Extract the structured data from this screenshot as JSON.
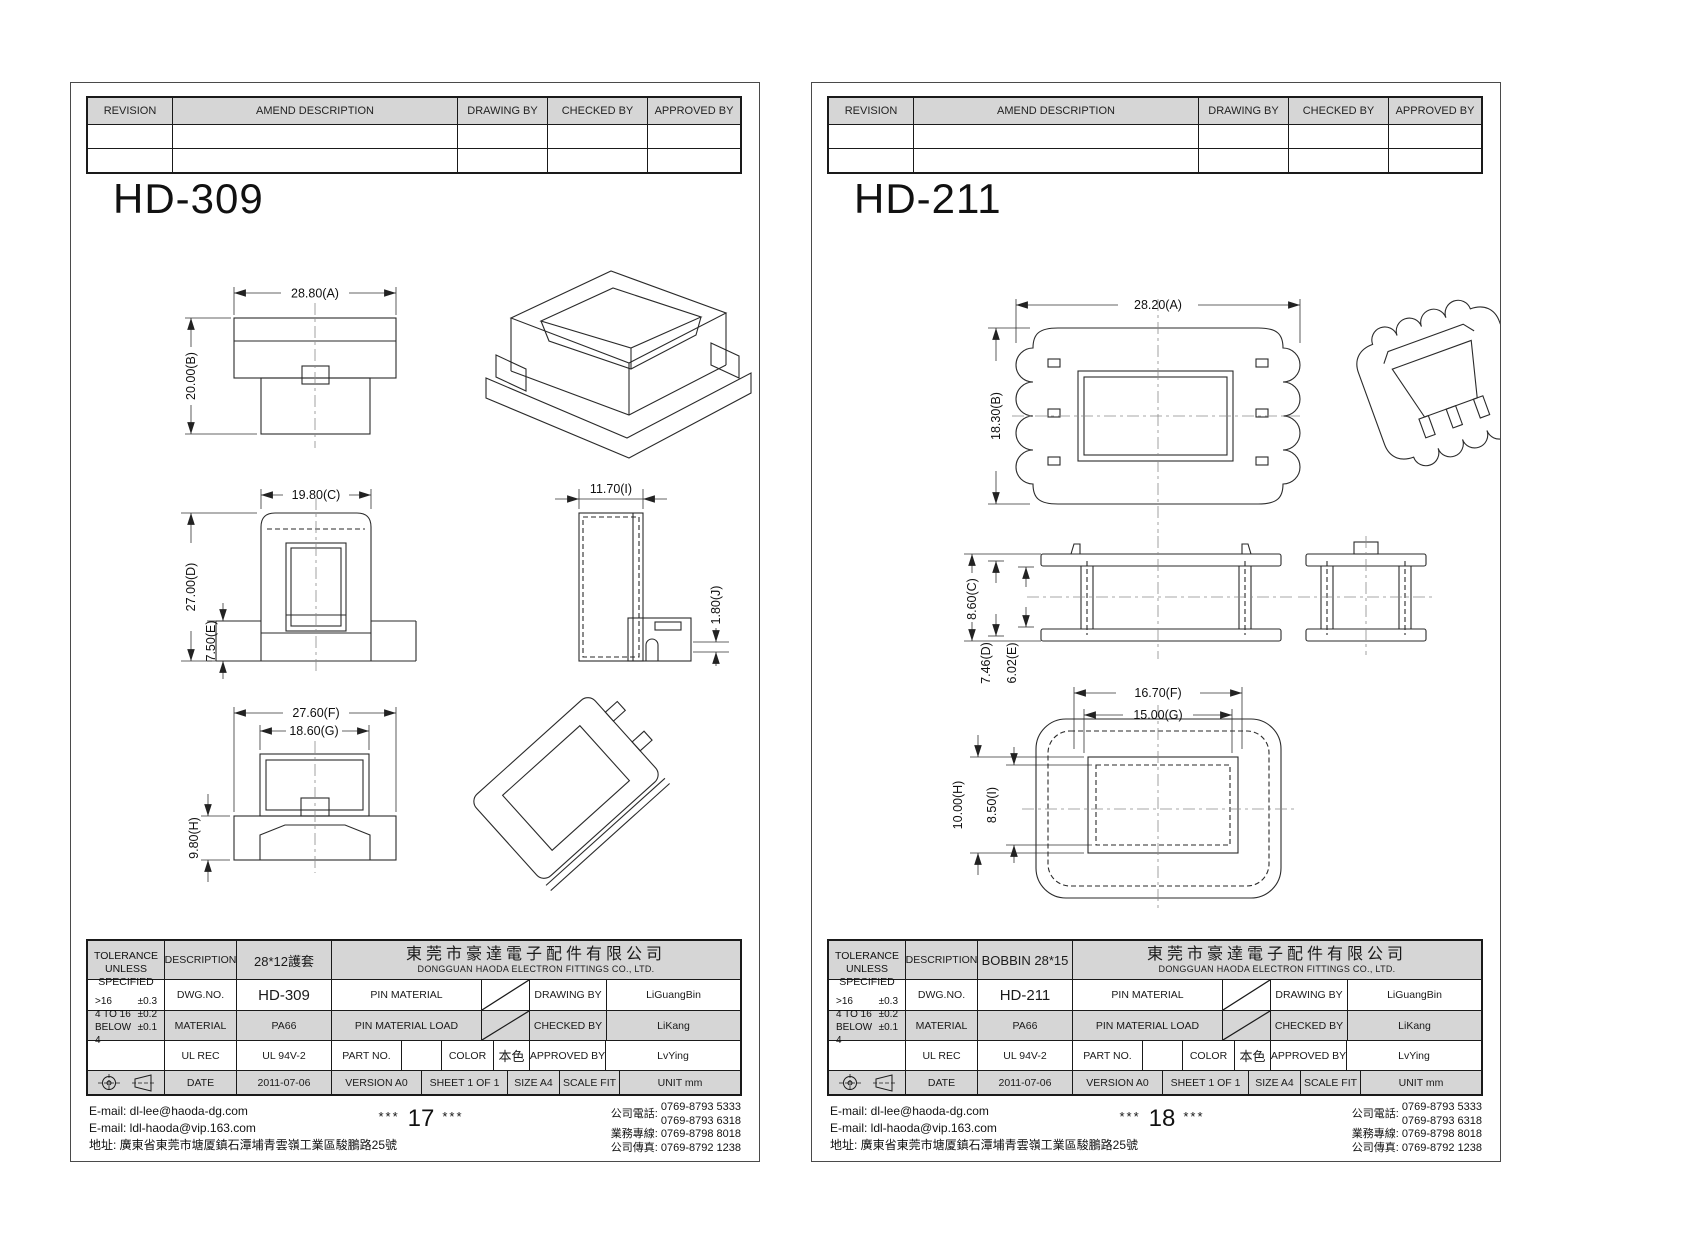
{
  "colors": {
    "grey_header": "#d6d6d6",
    "line": "#1a1a1a",
    "paper": "#ffffff"
  },
  "revision_headers": [
    "REVISION",
    "AMEND DESCRIPTION",
    "DRAWING BY",
    "CHECKED BY",
    "APPROVED BY"
  ],
  "company": {
    "cn": "東莞市豪達電子配件有限公司",
    "en": "DONGGUAN HAODA ELECTRON FITTINGS CO., LTD."
  },
  "tolerance": {
    "title_l1": "TOLERANCE",
    "title_l2": "UNLESS",
    "title_l3": "SPECIFIED",
    "rows": [
      {
        "range": ">16",
        "value": "±0.3"
      },
      {
        "range": "4 TO 16",
        "value": "±0.2"
      },
      {
        "range": "BELOW 4",
        "value": "±0.1"
      }
    ]
  },
  "labels": {
    "description": "DESCRIPTION",
    "dwg_no": "DWG.NO.",
    "material": "MATERIAL",
    "ul_rec": "UL REC",
    "date": "DATE",
    "pin_material": "PIN MATERIAL",
    "pin_material_load": "PIN MATERIAL LOAD",
    "part_no": "PART NO.",
    "color": "COLOR",
    "drawing_by": "DRAWING BY",
    "checked_by": "CHECKED BY",
    "approved_by": "APPROVED BY"
  },
  "values": {
    "material": "PA66",
    "ul_rec": "UL 94V-2",
    "color": "本色",
    "date": "2011-07-06",
    "drawing_by": "LiGuangBin",
    "checked_by": "LiKang",
    "approved_by": "LvYing",
    "version": "VERSION A0",
    "sheet": "SHEET 1 OF 1",
    "size": "SIZE A4",
    "scale": "SCALE FIT",
    "unit": "UNIT mm"
  },
  "footer": {
    "email1": "E-mail: dl-lee@haoda-dg.com",
    "email2": "E-mail: ldl-haoda@vip.163.com",
    "address": "地址: 廣東省東莞市塘厦鎮石潭埔青雲嶺工業區駿鵬路25號",
    "stars": "***",
    "phone_label": "公司電話:",
    "phone1": "0769-8793 5333",
    "phone2": "0769-8793 6318",
    "biz_label": "業務專線:",
    "biz": "0769-8798 8018",
    "fax_label": "公司傳真:",
    "fax": "0769-8792 1238"
  },
  "pages": [
    {
      "title": "HD-309",
      "description": "28*12護套",
      "dwg_no": "HD-309",
      "page_num": "17",
      "dims": {
        "A": "28.80(A)",
        "B": "20.00(B)",
        "C": "19.80(C)",
        "D": "27.00(D)",
        "E": "7.50(E)",
        "F": "27.60(F)",
        "G": "18.60(G)",
        "H": "9.80(H)",
        "I": "11.70(I)",
        "J": "1.80(J)"
      }
    },
    {
      "title": "HD-211",
      "description": "BOBBIN 28*15",
      "dwg_no": "HD-211",
      "page_num": "18",
      "dims": {
        "A": "28.20(A)",
        "B": "18.30(B)",
        "C": "8.60(C)",
        "D": "7.46(D)",
        "E": "6.02(E)",
        "F": "16.70(F)",
        "G": "15.00(G)",
        "H": "10.00(H)",
        "I": "8.50(I)"
      }
    }
  ]
}
